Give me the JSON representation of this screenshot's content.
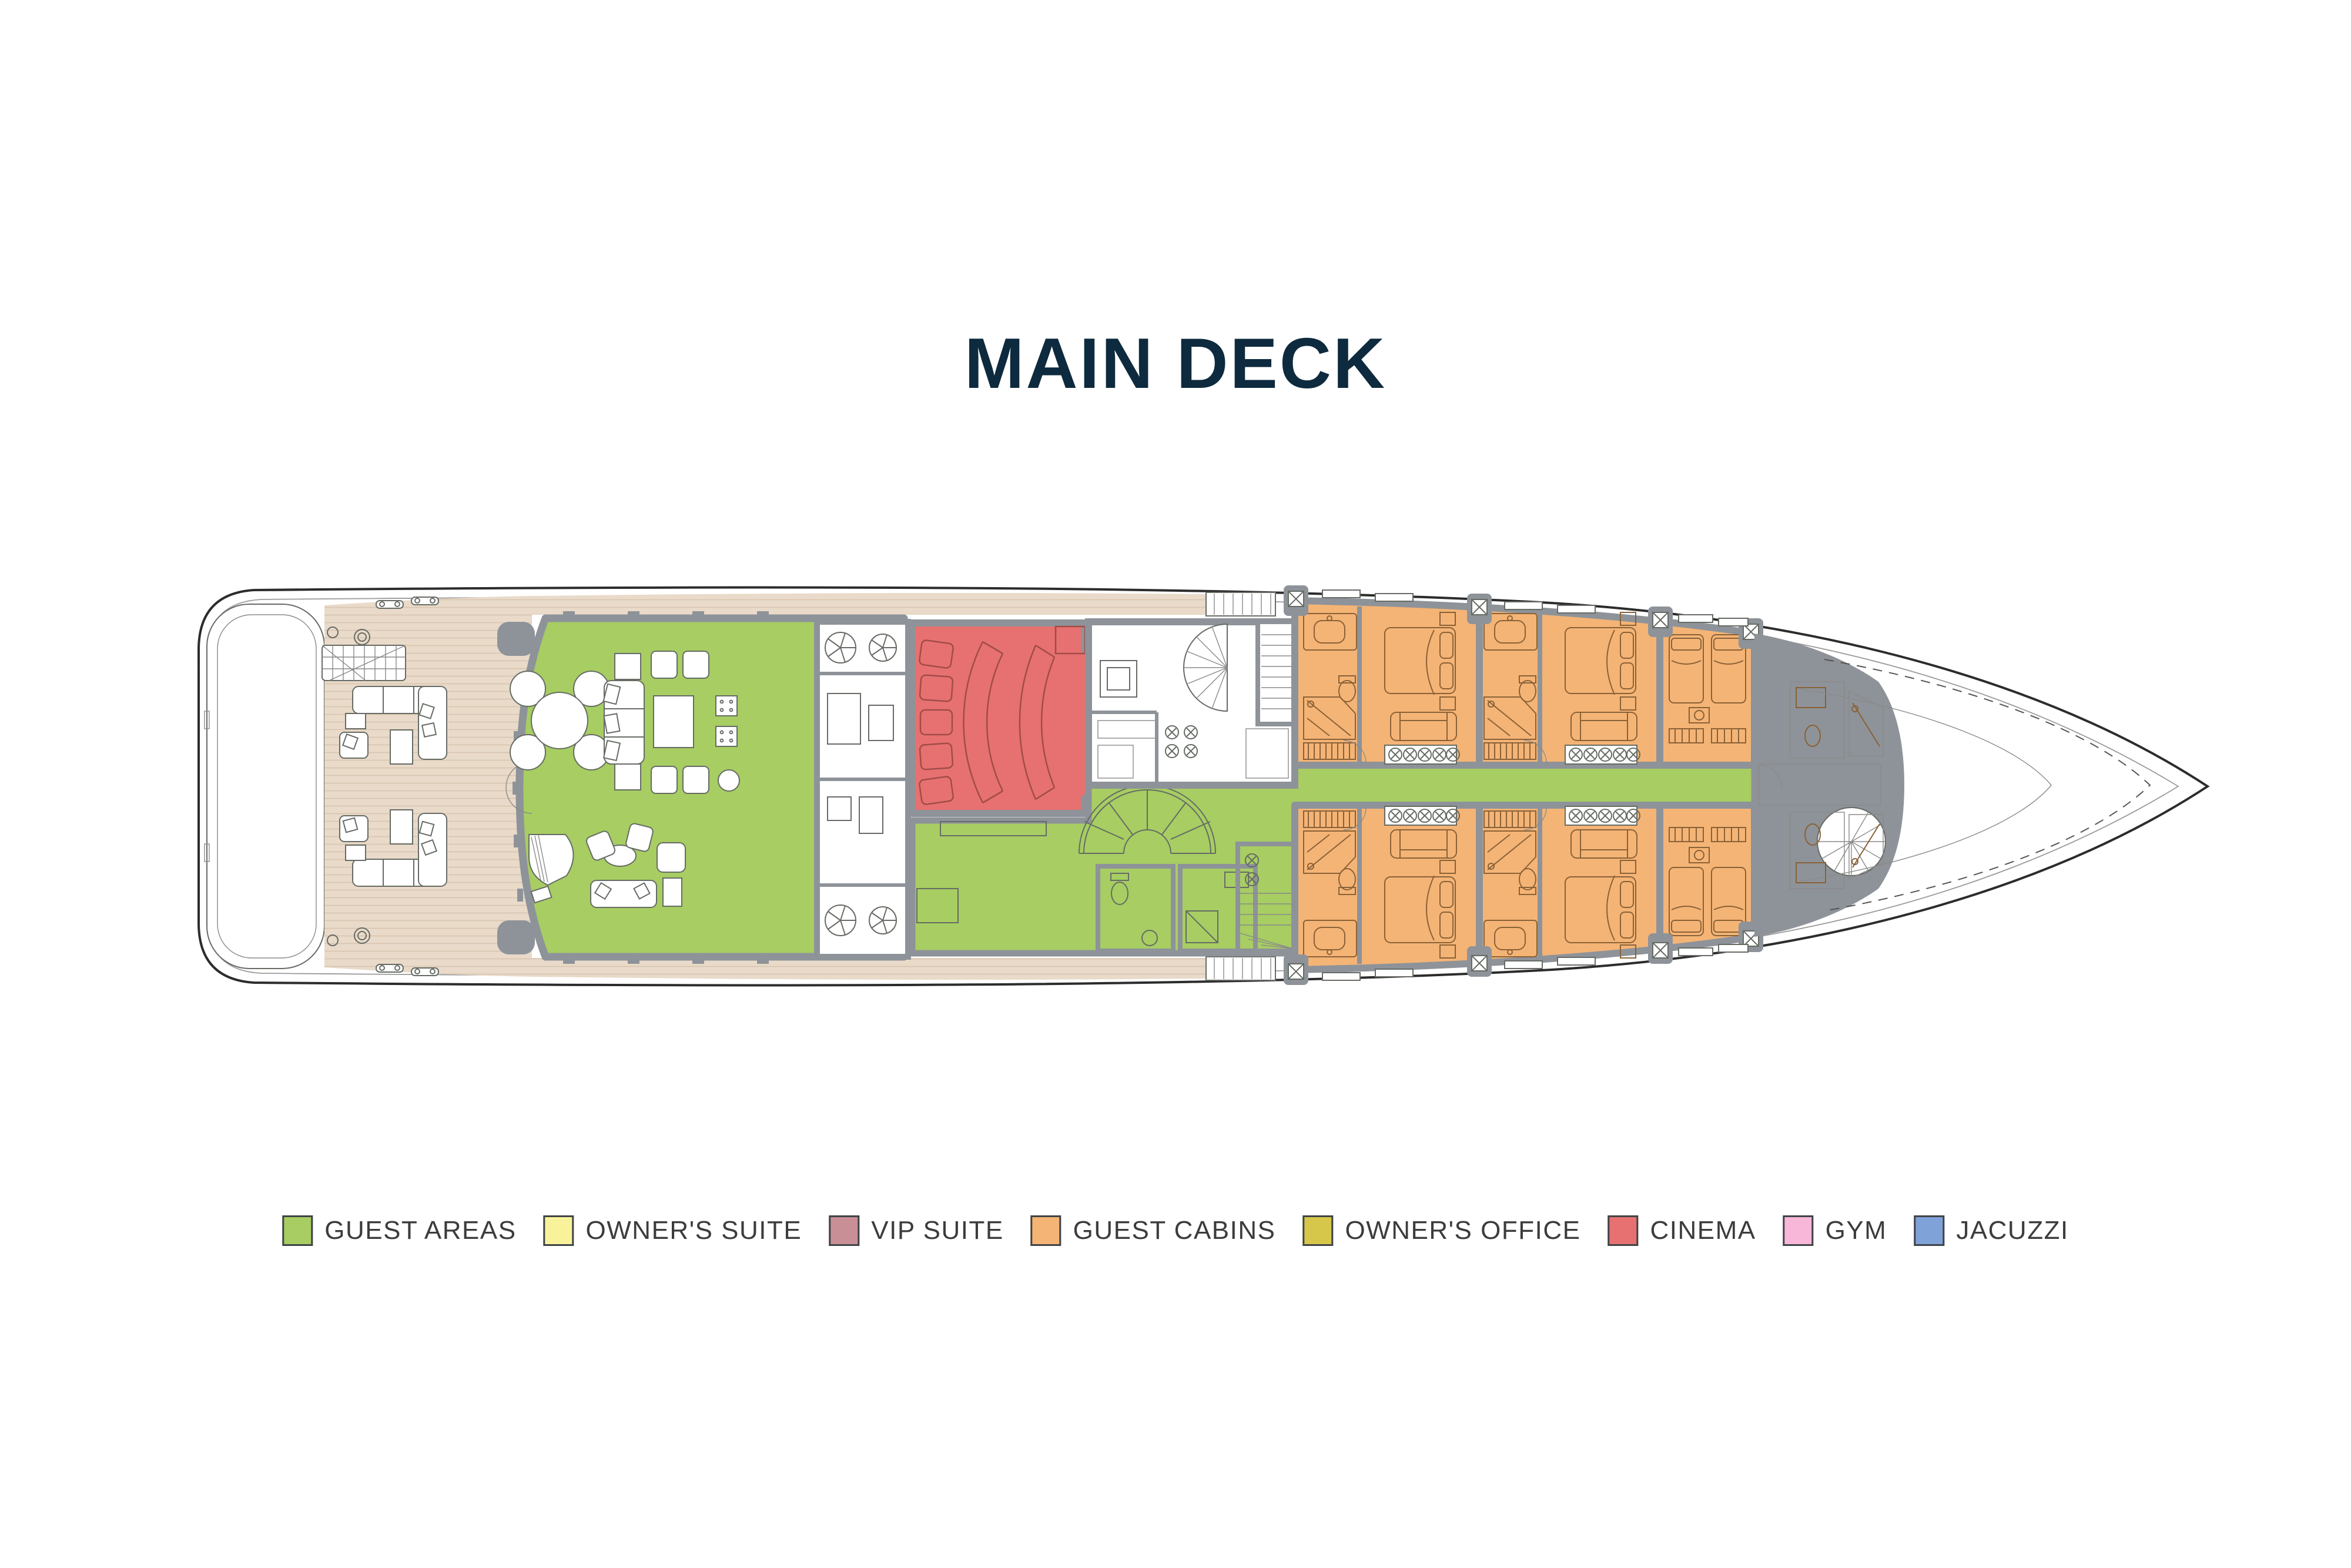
{
  "title": "MAIN DECK",
  "title_color": "#0d2a3e",
  "legend": {
    "items": [
      {
        "id": "guest-areas",
        "label": "GUEST AREAS",
        "color": "#a7cd63"
      },
      {
        "id": "owners-suite",
        "label": "OWNER'S SUITE",
        "color": "#f8f29b"
      },
      {
        "id": "vip-suite",
        "label": "VIP SUITE",
        "color": "#c98f97"
      },
      {
        "id": "guest-cabins",
        "label": "GUEST CABINS",
        "color": "#f4b476"
      },
      {
        "id": "owners-office",
        "label": "OWNER'S OFFICE",
        "color": "#d6c74b"
      },
      {
        "id": "cinema",
        "label": "CINEMA",
        "color": "#e77170"
      },
      {
        "id": "gym",
        "label": "GYM",
        "color": "#f8b7d8"
      },
      {
        "id": "jacuzzi",
        "label": "JACUZZI",
        "color": "#7fa3d8"
      }
    ]
  },
  "plan": {
    "deck_name": "MAIN DECK",
    "zones": {
      "guest_areas": "#a7cd63",
      "guest_cabins": "#f4b476",
      "cinema": "#e77170",
      "deck_teak": "#e9dac9",
      "walls": "#8e9399"
    }
  }
}
